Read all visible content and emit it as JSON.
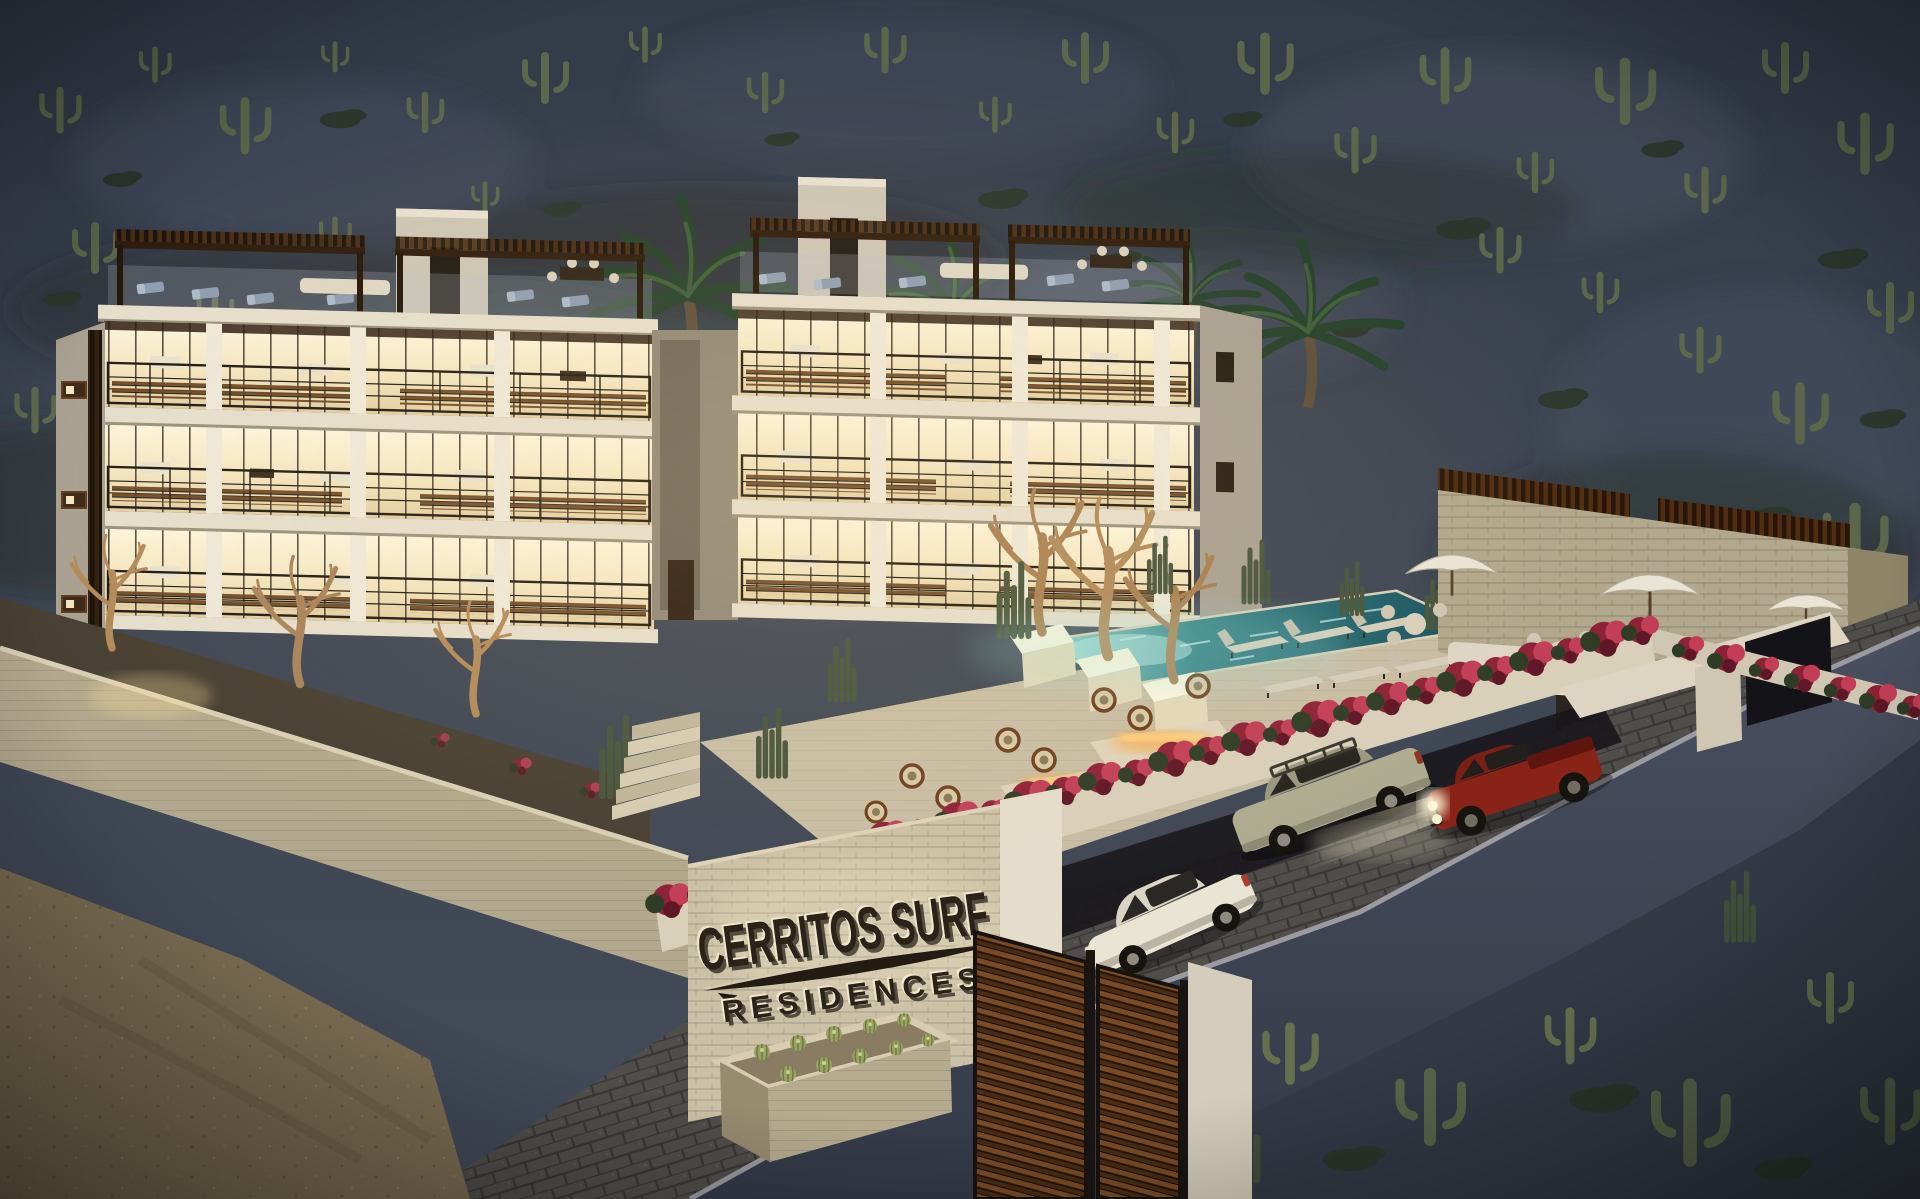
{
  "scene": {
    "sign": {
      "line1": "CERRITOS SURF",
      "line2": "RESIDENCES"
    },
    "vehicles": [
      {
        "name": "white-hatchback",
        "color": "#e9e4d3"
      },
      {
        "name": "beige-suv-with-roof-rack",
        "color": "#aeab90"
      },
      {
        "name": "red-pickup-headlights-on",
        "color": "#8a2317"
      }
    ],
    "features": [
      "desert hillside with saguaro cacti",
      "palm trees",
      "four-story condo with lit glass facades",
      "rooftop pergola terraces",
      "swimming pool with underwater lights",
      "fire pit lounge",
      "umbrella dining pavilion",
      "bougainvillea-topped walls",
      "cobblestone driveway",
      "wood entry gate",
      "barrel cactus planter",
      "dirt road"
    ],
    "colors": {
      "hill": "#3c4452",
      "hilllight": "#525b6b",
      "brush": "#2c362c",
      "cactus": "#5b664b",
      "palm": "#24402b",
      "facade": "#efe9da",
      "facadeshade": "#cdc6b5",
      "gable": "#a8a092",
      "glass": "#f7edd3",
      "slab": "#e6dfce",
      "wood": "#6b4524",
      "wooddark": "#2e1c0d",
      "rail": "#201913",
      "stone": "#b2a88d",
      "pool": "#1e6570",
      "poolglow": "#9adcd8",
      "flower": "#8e2136",
      "flowerbright": "#c23e57",
      "leaf": "#2e3c26",
      "deck": "#c8bea5",
      "cobble": "#5f5b54",
      "dirt": "#7b6d52",
      "walldark": "#3d4250",
      "fire": "#ffa13c",
      "furniture": "#8e9cb2",
      "sofa": "#ded7c5"
    }
  }
}
